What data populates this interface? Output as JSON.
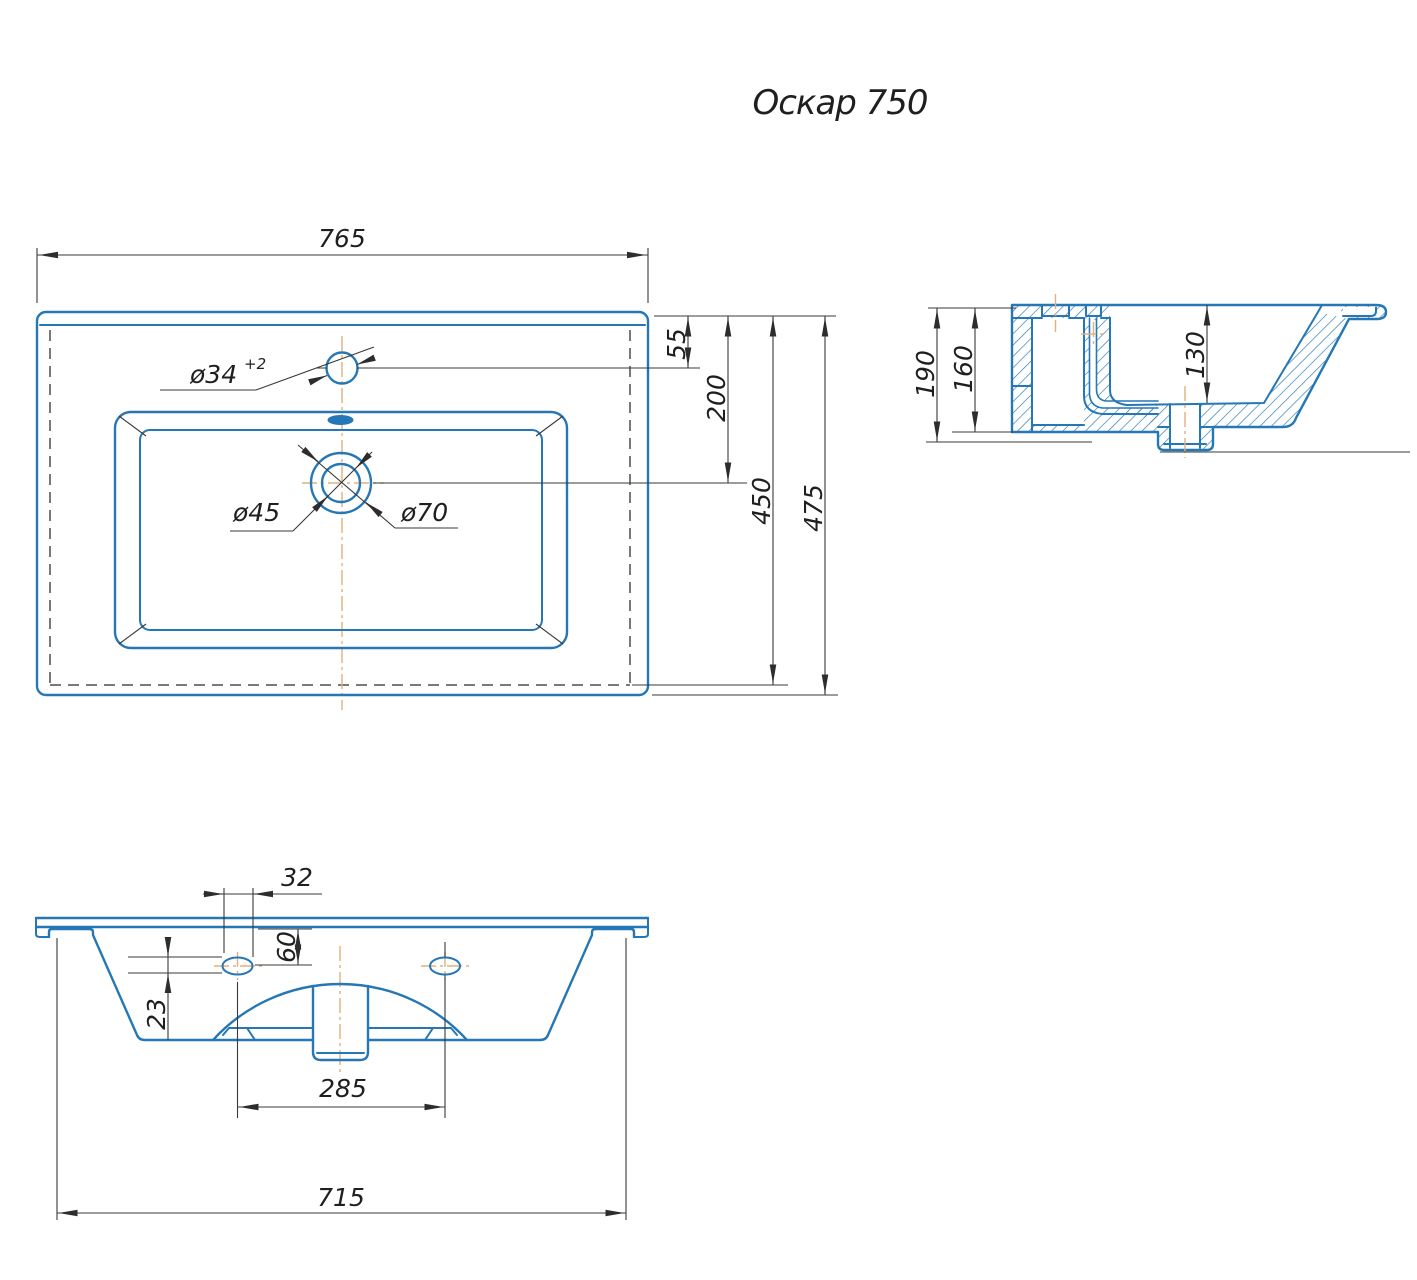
{
  "title": "Оскар 750",
  "colors": {
    "outline": "#2577b5",
    "dimension": "#3a3a3a",
    "centerline": "#e2b07c",
    "hidden": "#4d4d4d",
    "text": "#1f1f1f"
  },
  "plan": {
    "width": "765",
    "faucet_offset": "55",
    "drain_offset": "200",
    "inner_depth": "450",
    "depth": "475",
    "faucet_dia": "ø34",
    "faucet_dia_tol": "+2",
    "drain_dia": "ø45",
    "drain_outer_dia": "ø70"
  },
  "section": {
    "height_total": "190",
    "height_body": "160",
    "bowl_depth": "130"
  },
  "bottom": {
    "slot_width": "32",
    "slot_offset": "60",
    "slot_height": "23",
    "hole_spacing": "285",
    "base_width": "715"
  }
}
